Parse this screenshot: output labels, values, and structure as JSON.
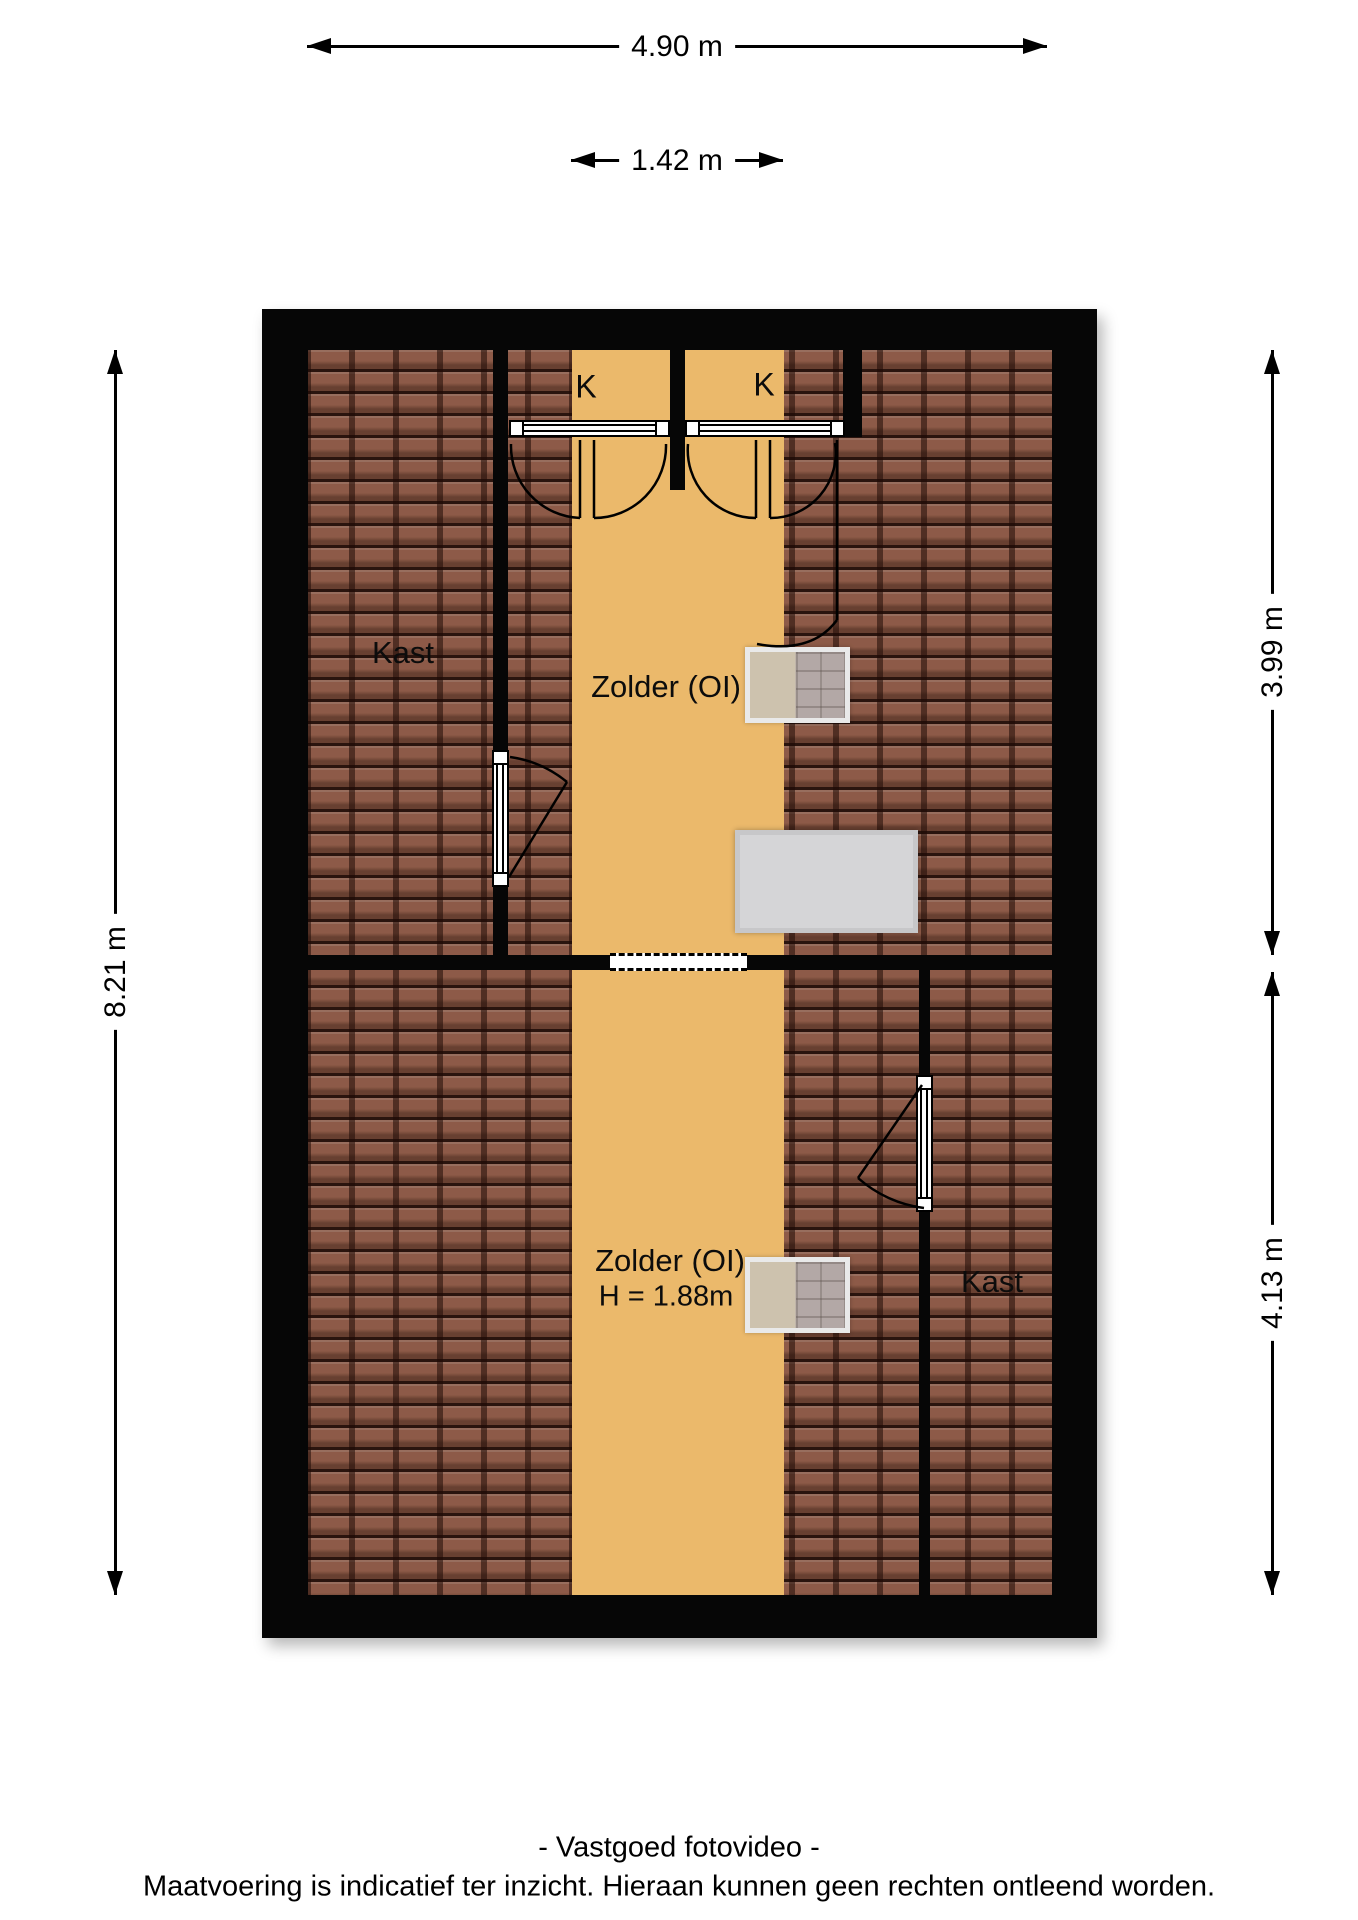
{
  "title": "Zolder floor plan",
  "dimensions": {
    "width_top": "4.90 m",
    "corridor_width": "1.42 m",
    "height_left": "8.21 m",
    "upper_right": "3.99 m",
    "lower_right": "4.13 m"
  },
  "rooms": {
    "closet_upper_left": "Kast",
    "closet_k1": "K",
    "closet_k2": "K",
    "attic_upper": "Zolder (OI)",
    "attic_lower": "Zolder (OI)",
    "attic_lower_height": "H = 1.88m",
    "closet_lower_right": "Kast"
  },
  "footer": {
    "line1": "- Vastgoed fotovideo -",
    "line2": "Maatvoering is indicatief ter inzicht. Hieraan kunnen geen rechten ontleend worden."
  },
  "colors": {
    "floor_orange": "#ebb96b",
    "roof_tile_brown": "#8a5a48",
    "wall_black": "#060606",
    "object_gray": "#d5d5d7",
    "background": "#ffffff"
  },
  "icons": {
    "roof_window": "roof-window-grid",
    "door_swing": "quarter-arc"
  }
}
